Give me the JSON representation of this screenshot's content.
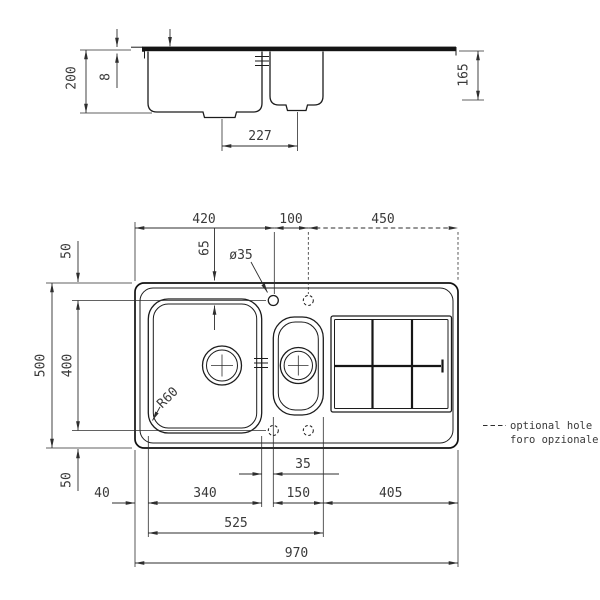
{
  "side_view": {
    "bowl_depth": "200",
    "rim_thickness": "8",
    "right_depth": "165",
    "drain_distance": "227"
  },
  "plan_view": {
    "edge_to_tap_hole": "420",
    "hole_spacing": "100",
    "hole_to_right_edge": "450",
    "hole_inset": "65",
    "hole_diameter": "ø35",
    "total_depth": "500",
    "hole_lines_span": "400",
    "top_margin": "50",
    "bottom_margin": "50",
    "bowl_corner_radius": "R60",
    "left_margin": "40",
    "main_bowl_width": "340",
    "bowl_gap": "35",
    "half_bowl_width": "150",
    "drainer_span": "405",
    "bowls_span": "525",
    "total_width": "970"
  },
  "legend": {
    "line1": "optional hole",
    "line2": "foro opzionale"
  }
}
